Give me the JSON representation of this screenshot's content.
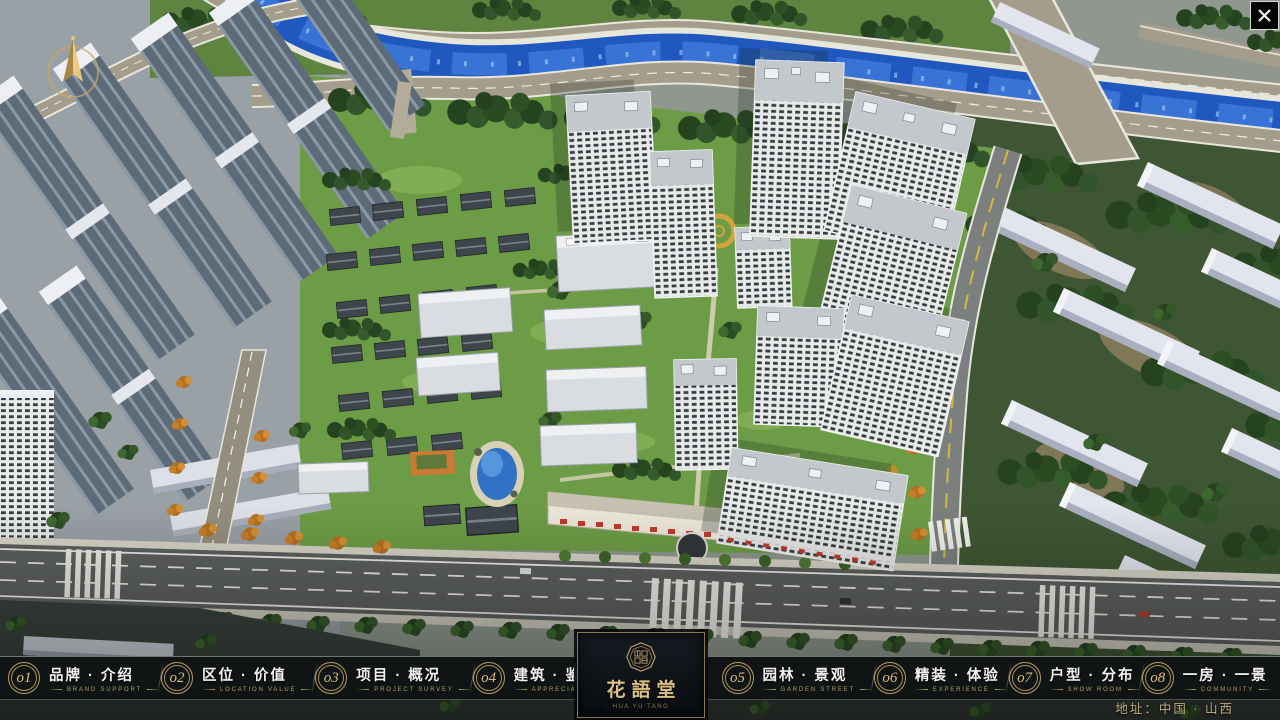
{
  "window": {
    "close_glyph": "✕"
  },
  "nav": {
    "items": [
      {
        "num": "o1",
        "zh": "品牌 · 介绍",
        "en": "BRAND SUPPORT"
      },
      {
        "num": "o2",
        "zh": "区位 · 价值",
        "en": "LOCATION VALUE"
      },
      {
        "num": "o3",
        "zh": "项目 · 概况",
        "en": "PROJECT SURVEY"
      },
      {
        "num": "o4",
        "zh": "建筑 · 鉴赏",
        "en": "APPRECIATION"
      },
      {
        "num": "o5",
        "zh": "园林 · 景观",
        "en": "GARDEN STREET"
      },
      {
        "num": "o6",
        "zh": "精装 · 体验",
        "en": "EXPERIENCE"
      },
      {
        "num": "o7",
        "zh": "户型 · 分布",
        "en": "SHOW ROOM"
      },
      {
        "num": "o8",
        "zh": "一房 · 一景",
        "en": "COMMUNITY"
      }
    ]
  },
  "logo": {
    "title": "花語堂",
    "caption": "· HUA YU TANG ·"
  },
  "footer": {
    "address": "地址：中国 · 山西"
  },
  "colors": {
    "gold": "#c9a86a",
    "bar_bg": "rgba(10,13,16,0.74)",
    "zh_text": "#f2f1ed",
    "en_text": "#b69c63"
  }
}
